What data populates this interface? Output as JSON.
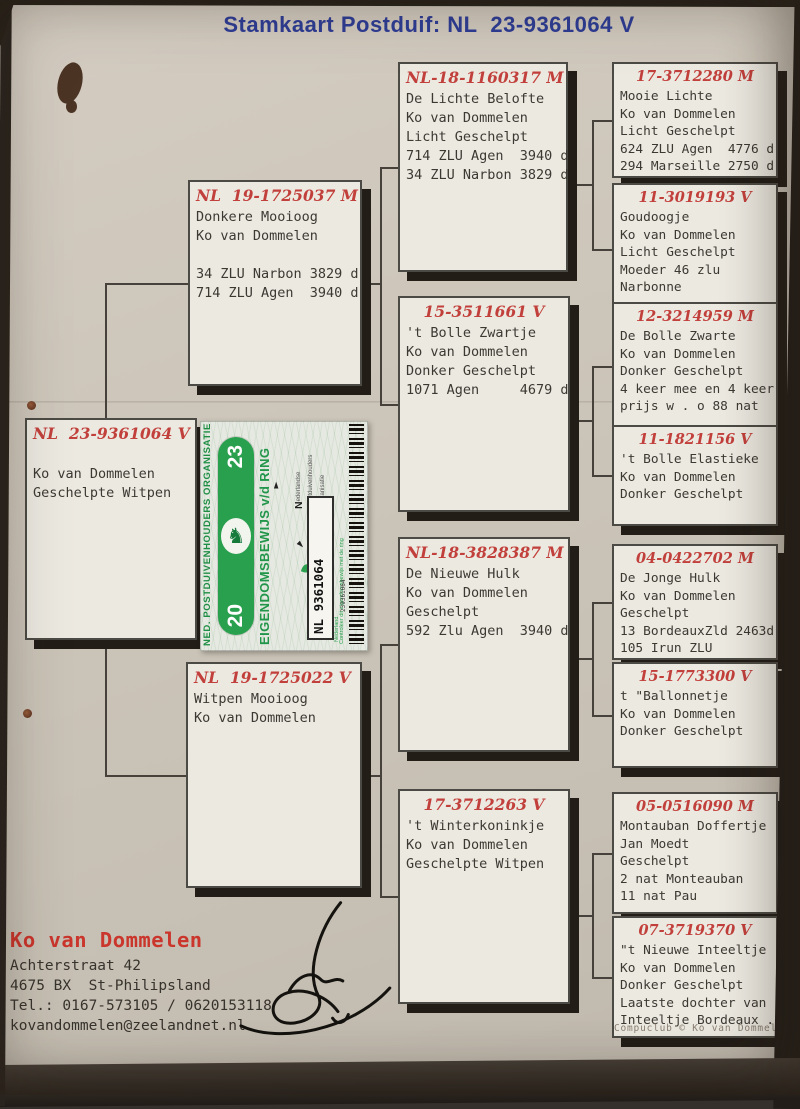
{
  "title": "Stamkaart Postduif: NL  23-9361064 V",
  "boxes": [
    {
      "ring": "NL  23-9361064 V",
      "lines": [
        "",
        "Ko van Dommelen",
        "Geschelpte Witpen"
      ]
    },
    {
      "ring": "NL  19-1725037 M",
      "lines": [
        "Donkere Mooioog",
        "Ko van Dommelen",
        "",
        "34 ZLU Narbon 3829 d",
        "714 ZLU Agen  3940 d"
      ]
    },
    {
      "ring": "NL  19-1725022 V",
      "lines": [
        "Witpen Mooioog",
        "Ko van Dommelen"
      ]
    },
    {
      "ring": "NL-18-1160317 M",
      "lines": [
        "De Lichte Belofte",
        "Ko van Dommelen",
        "Licht Geschelpt",
        "714 ZLU Agen  3940 d",
        "34 ZLU Narbon 3829 d"
      ]
    },
    {
      "ring": "15-3511661 V",
      "lines": [
        "'t Bolle Zwartje",
        "Ko van Dommelen",
        "Donker Geschelpt",
        "1071 Agen     4679 d"
      ]
    },
    {
      "ring": "NL-18-3828387 M",
      "lines": [
        "De Nieuwe Hulk",
        "Ko van Dommelen",
        "Geschelpt",
        "592 Zlu Agen  3940 d"
      ]
    },
    {
      "ring": "17-3712263 V",
      "lines": [
        "'t Winterkoninkje",
        "Ko van Dommelen",
        "Geschelpte Witpen"
      ]
    },
    {
      "ring": "17-3712280 M",
      "lines": [
        "Mooie Lichte",
        "Ko van Dommelen",
        "Licht Geschelpt",
        "624 ZLU Agen  4776 d",
        "294 Marseille 2750 d"
      ]
    },
    {
      "ring": "11-3019193 V",
      "lines": [
        "Goudoogje",
        "Ko van Dommelen",
        "Licht Geschelpt",
        "Moeder 46 zlu",
        "Narbonne"
      ]
    },
    {
      "ring": "12-3214959 M",
      "lines": [
        "De Bolle Zwarte",
        "Ko van Dommelen",
        "Donker Geschelpt",
        "4 keer mee en 4 keer",
        "prijs w . o 88 nat"
      ]
    },
    {
      "ring": "11-1821156 V",
      "lines": [
        "'t Bolle Elastieke",
        "Ko van Dommelen",
        "Donker Geschelpt"
      ]
    },
    {
      "ring": "04-0422702 M",
      "lines": [
        "De Jonge Hulk",
        "Ko van Dommelen",
        "Geschelpt",
        "13 BordeauxZld 2463d",
        "105 Irun ZLU"
      ]
    },
    {
      "ring": "15-1773300 V",
      "lines": [
        "t \"Ballonnetje",
        "Ko van Dommelen",
        "Donker Geschelpt"
      ]
    },
    {
      "ring": "05-0516090 M",
      "lines": [
        "Montauban Doffertje",
        "Jan Moedt",
        "Geschelpt",
        "2 nat Monteauban",
        "11 nat Pau"
      ]
    },
    {
      "ring": "07-3719370 V",
      "lines": [
        "\"t Nieuwe Inteeltje",
        "Ko van Dommelen",
        "Donker Geschelpt",
        "Laatste dochter van",
        "Inteeltje Bordeaux ."
      ]
    }
  ],
  "sticker": {
    "org": "NED. POSTDUIVENHOUDERS ORGANISATIE",
    "year_top": "23",
    "year_bottom": "20",
    "title": "EIGENDOMSBEWIJS v/d RING",
    "npo_words": [
      "Nederlandse",
      "Postduivenhouders",
      "Organisatie"
    ],
    "ring_box": "NL  9361064",
    "country_small": "Nederland",
    "verify_note": "Controleer dit eigendomsbewijs met de ring",
    "barcode_number": "239361064"
  },
  "owner": {
    "name": "Ko van Dommelen",
    "lines": [
      "Achterstraat 42",
      "4675 BX  St-Philipsland",
      "Tel.: 0167-573105 / 0620153118",
      "kovandommelen@zeelandnet.nl"
    ]
  },
  "credit": "Compuclub © Ko van Dommelen"
}
